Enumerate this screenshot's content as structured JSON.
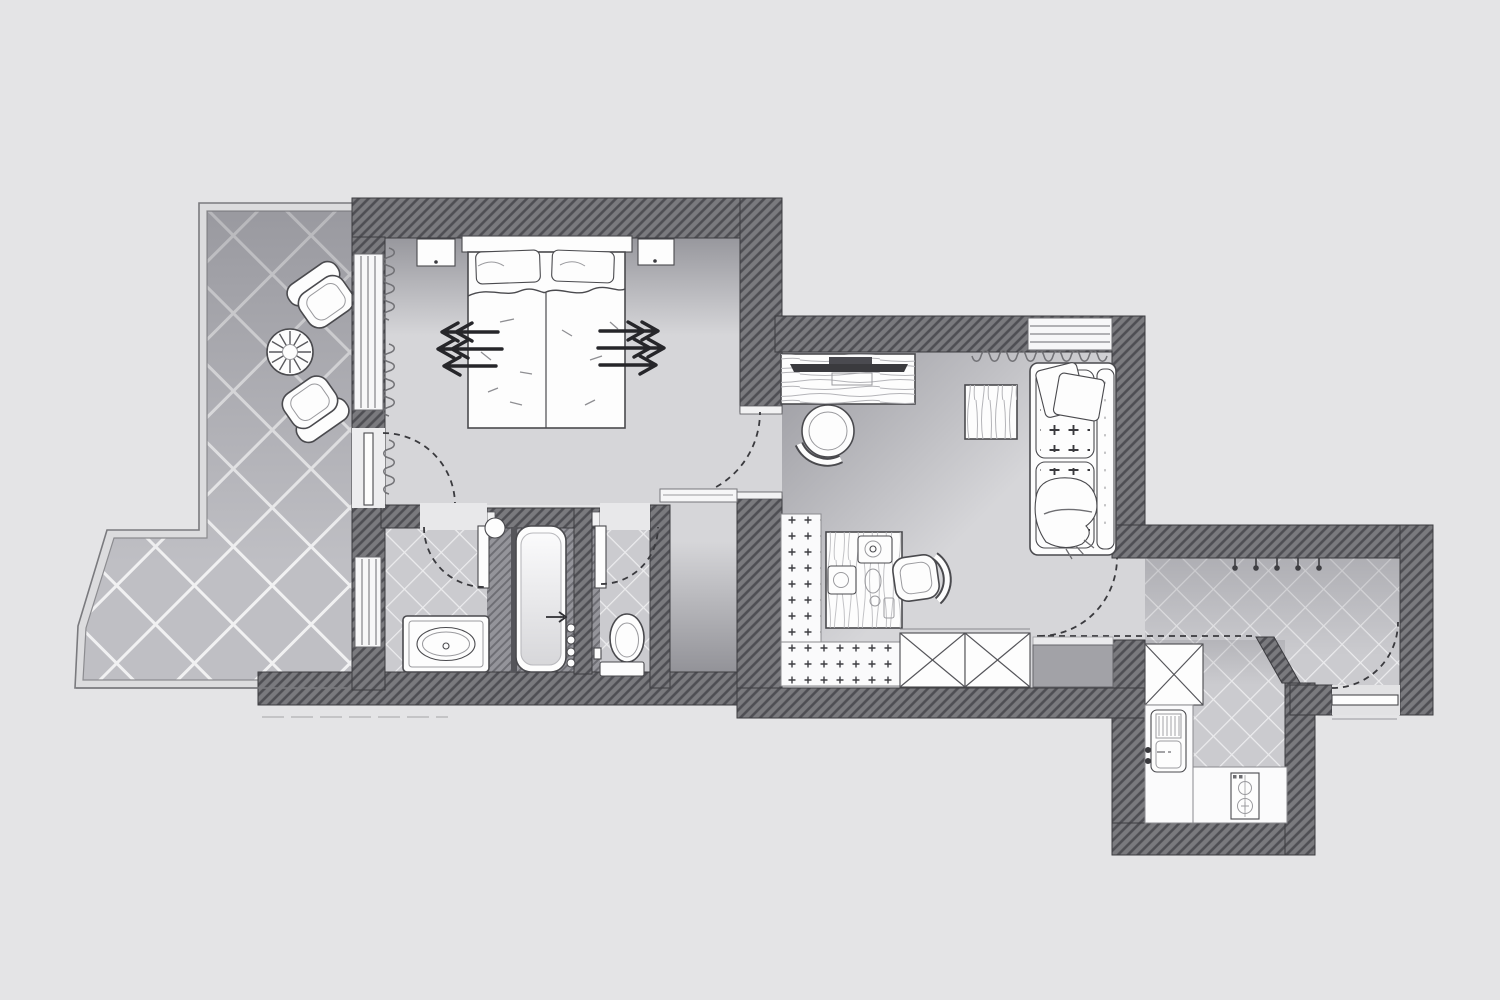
{
  "meta": {
    "description": "Hand-drawn grayscale architectural floor plan of a hotel suite, top-down view, pencil and watercolor style, no text labels visible"
  },
  "colors": {
    "background": "#e4e4e6",
    "plan_floor": "#d6d6d9",
    "wall_fill": "#7a7a7e",
    "wall_hatch": "rgba(25,25,30,0.45)",
    "wall_outline": "#3c3c40",
    "terrace_tile": "#bfbfc4",
    "terrace_grout": "#f1f1f2",
    "bath_tile": "#cbcbcf",
    "bath_grout": "#ececee",
    "furniture_fill": "#fdfdfd",
    "furniture_outline": "#4a4a4e",
    "detail_line": "#9a9a9e",
    "dark_line": "#26262a",
    "dash_color": "#3a3a3e",
    "tv_screen": "#3a3a3e",
    "sideboard_fill": "#a2a2a7",
    "platform_fill": "#94949a"
  },
  "rooms": {
    "terrace": {
      "floor": "large diagonal tiles with railing border",
      "items": [
        "armchair",
        "round wicker table",
        "armchair"
      ]
    },
    "bedroom": {
      "items": [
        "double bed with duvet",
        "headboard",
        "pillow left",
        "pillow right",
        "nightstand left",
        "nightstand right",
        "three arrows pointing left",
        "three arrows pointing right",
        "curtains on window wall"
      ],
      "openings": [
        "terrace door with swing arc",
        "door to living room with swing arc",
        "full-height window"
      ]
    },
    "bathroom": {
      "vanity_room": [
        "vanity counter with oval basin",
        "door with swing arc"
      ],
      "tub_room": [
        "bathtub",
        "round stool",
        "four control knobs",
        "small arrow"
      ],
      "wc_room": [
        "toilet",
        "door with swing arc"
      ]
    },
    "inner_hall": {
      "items": [
        "sill band to bedroom"
      ]
    },
    "living_room": {
      "items": [
        "desk with tv",
        "desk chair",
        "coffee table",
        "two-seat tufted sofa",
        "two sofa pillows",
        "throw blanket",
        "plus-pattern runner rug",
        "minibar table with two coffee machines, tray, cup",
        "side chair",
        "wardrobe with X front (x2)",
        "gray sideboard",
        "window with curtain"
      ]
    },
    "entrance_hall": {
      "items": [
        "five coat hooks",
        "closet with X front",
        "entrance door with swing arc",
        "diagonal wall piece",
        "dashed ceiling line"
      ]
    },
    "kitchen": {
      "items": [
        "sink unit with drainer",
        "two knobs",
        "stove with two burners",
        "L-shaped counter"
      ]
    }
  }
}
